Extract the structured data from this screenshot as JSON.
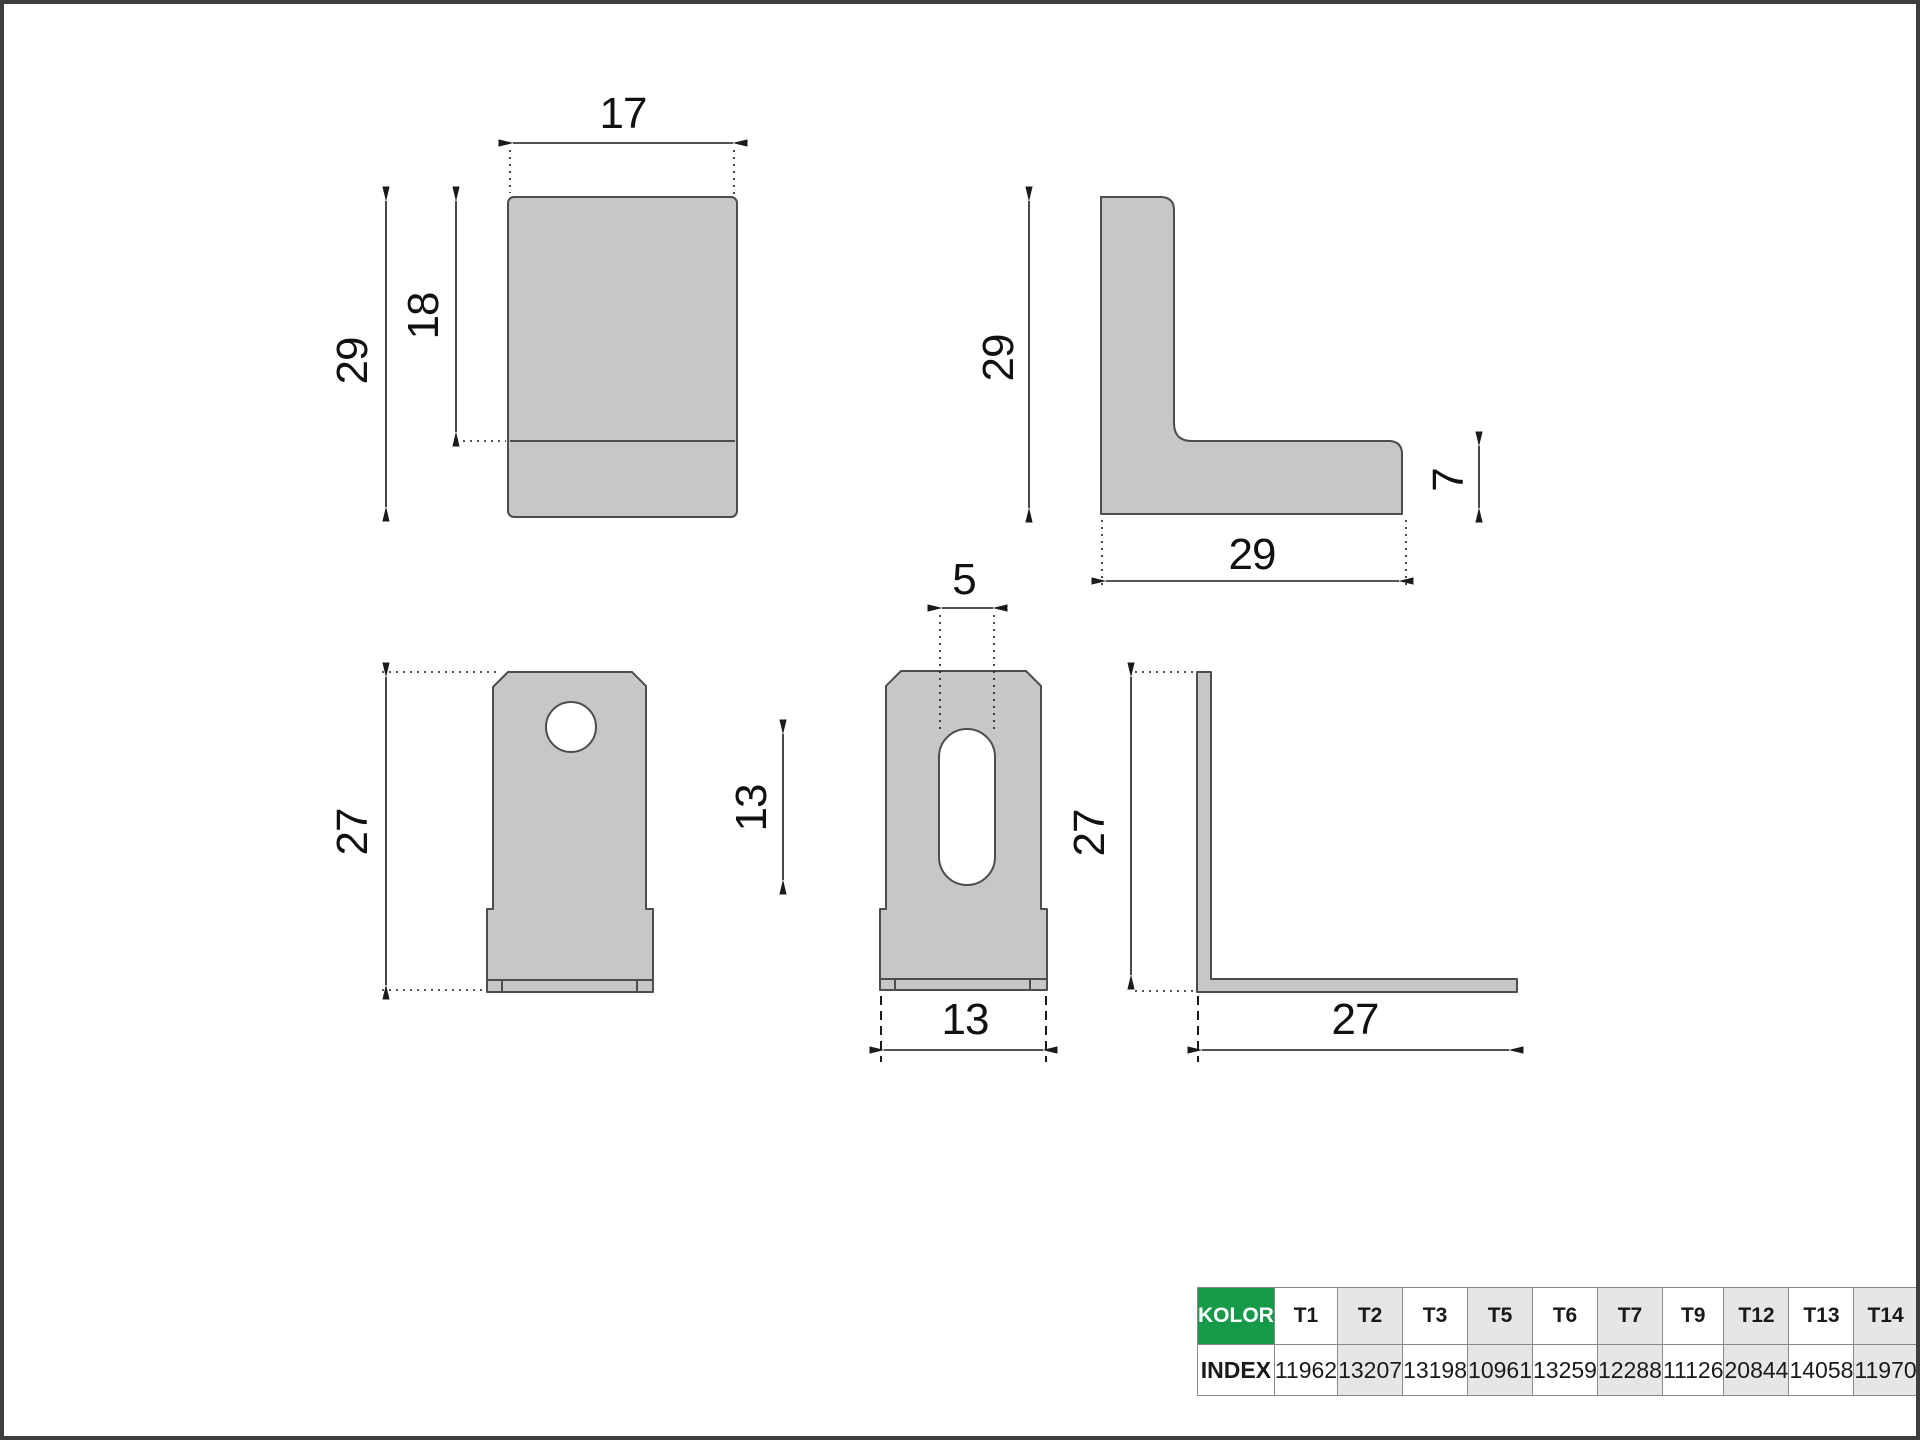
{
  "drawing": {
    "front_top_view": {
      "width": "17",
      "height": "29",
      "fold_height": "18"
    },
    "side_top_view": {
      "height": "29",
      "width": "29",
      "thickness": "7"
    },
    "front_bottom_view": {
      "height": "27"
    },
    "tab_bottom_view": {
      "slot_width": "5",
      "slot_length": "13",
      "width": "13"
    },
    "side_bottom_view": {
      "height": "27",
      "width": "27"
    }
  },
  "table": {
    "color_header": "KOLOR",
    "index_header": "INDEX",
    "columns": [
      {
        "color": "T1",
        "index": "11962"
      },
      {
        "color": "T2",
        "index": "13207"
      },
      {
        "color": "T3",
        "index": "13198"
      },
      {
        "color": "T5",
        "index": "10961"
      },
      {
        "color": "T6",
        "index": "13259"
      },
      {
        "color": "T7",
        "index": "12288"
      },
      {
        "color": "T9",
        "index": "11126"
      },
      {
        "color": "T12",
        "index": "20844"
      },
      {
        "color": "T13",
        "index": "14058"
      },
      {
        "color": "T14",
        "index": "11970"
      }
    ],
    "accent_green": "#169a49",
    "shaded_cell": "#e6e6e6"
  },
  "part": {
    "fill": "#c7c7c7",
    "stroke": "#4d4d4d"
  }
}
